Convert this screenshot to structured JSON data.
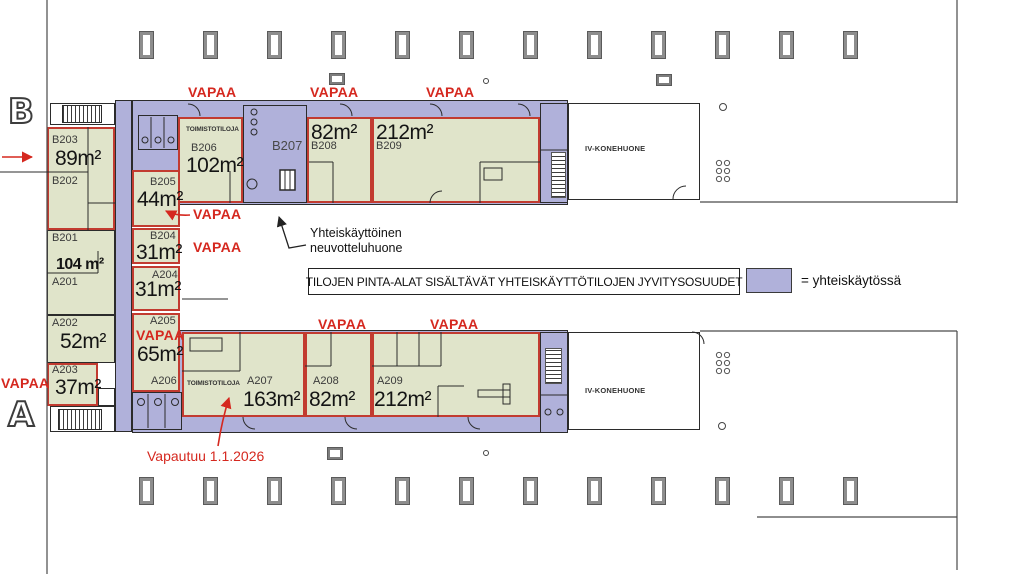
{
  "plan": {
    "section_b_label": "B",
    "section_a_label": "A",
    "vapaa_label": "VAPAA",
    "vacating_note": "Vapautuu 1.1.2026",
    "shared_room_note_line1": "Yhteiskäyttöinen",
    "shared_room_note_line2": "neuvotteluhuone",
    "info_note": "TILOJEN PINTA-ALAT SISÄLTÄVÄT YHTEISKÄYTTÖTILOJEN JYVITYSOSUUDET",
    "legend_label": "= yhteiskäytössä",
    "office_space_label": "TOIMISTOTILOJA",
    "hvac_room_label": "IV-KONEHUONE"
  },
  "rooms": {
    "b203": {
      "id": "B203",
      "area": "89m²"
    },
    "b202": {
      "id": "B202"
    },
    "b201": {
      "id": "B201",
      "area": "104 m²"
    },
    "a201": {
      "id": "A201"
    },
    "a202": {
      "id": "A202",
      "area": "52m²"
    },
    "a203": {
      "id": "A203",
      "area": "37m²"
    },
    "b205": {
      "id": "B205",
      "area": "44m²"
    },
    "b204": {
      "id": "B204",
      "area": "31m²"
    },
    "a204": {
      "id": "A204",
      "area": "31m²"
    },
    "a205": {
      "id": "A205",
      "area": "65m²"
    },
    "a206": {
      "id": "A206"
    },
    "b206": {
      "id": "B206",
      "area": "102m²"
    },
    "b207": {
      "id": "B207"
    },
    "b208": {
      "id": "B208",
      "area": "82m²"
    },
    "b209": {
      "id": "B209",
      "area": "212m²"
    },
    "a207": {
      "id": "A207",
      "area": "163m²"
    },
    "a208": {
      "id": "A208",
      "area": "82m²"
    },
    "a209": {
      "id": "A209",
      "area": "212m²"
    }
  },
  "colors": {
    "available_outline_red": "#c23b30",
    "available_text_red": "#d5281f",
    "shared_use_purple": "#b0b1da",
    "office_green": "#e0e4ca"
  }
}
